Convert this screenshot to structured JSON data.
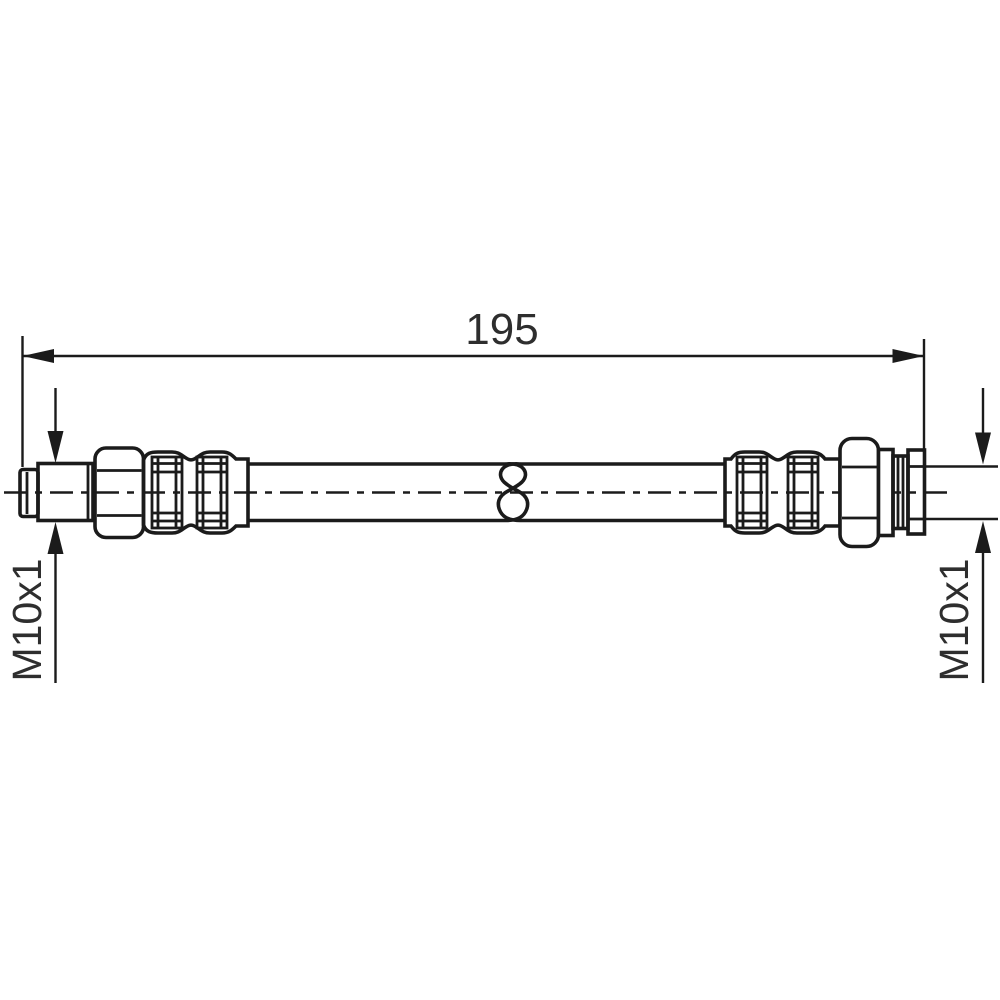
{
  "drawing": {
    "kind": "hose-technical-drawing",
    "colors": {
      "line": "#1b1b1b",
      "text": "#2e2e2e",
      "background": "#ffffff"
    },
    "labels": {
      "overall_length": "195",
      "left_thread": "M10x1",
      "right_thread": "M10x1"
    }
  }
}
